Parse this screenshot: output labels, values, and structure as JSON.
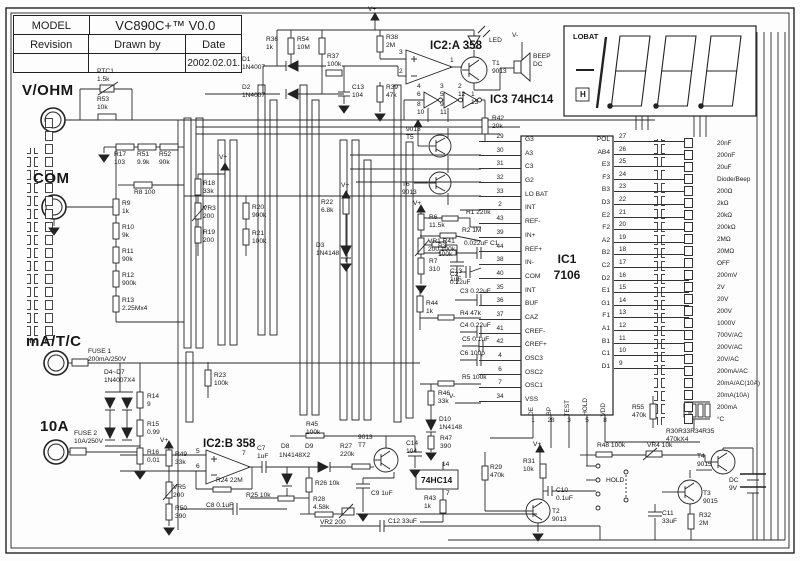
{
  "title_block": {
    "model_label": "MODEL",
    "model_value": "VC890C+™ V0.0",
    "revision_label": "Revision",
    "drawn_by_label": "Drawn by",
    "date_label": "Date",
    "date_value": "2002.02.01."
  },
  "terminals": {
    "vohm": "V/OHM",
    "com": "COM",
    "matc": "mA/T/C",
    "a10": "10A"
  },
  "display": {
    "lobat": "LOBAT",
    "hold_symbol": "H"
  },
  "ic1": {
    "name": "IC1",
    "part": "7106",
    "left_pins": [
      {
        "n": "29",
        "l": "G3"
      },
      {
        "n": "30",
        "l": "A3"
      },
      {
        "n": "31",
        "l": "C3"
      },
      {
        "n": "32",
        "l": "G2"
      },
      {
        "n": "33",
        "l": "LO BAT"
      },
      {
        "n": "2",
        "l": "INT"
      },
      {
        "n": "43",
        "l": "REF-"
      },
      {
        "n": "39",
        "l": "IN+"
      },
      {
        "n": "44",
        "l": "REF+"
      },
      {
        "n": "38",
        "l": "IN-"
      },
      {
        "n": "40",
        "l": "COM"
      },
      {
        "n": "35",
        "l": "INT"
      },
      {
        "n": "36",
        "l": "BUF"
      },
      {
        "n": "37",
        "l": "CAZ"
      },
      {
        "n": "41",
        "l": "CREF-"
      },
      {
        "n": "42",
        "l": "CREF+"
      },
      {
        "n": "4",
        "l": "OSC3"
      },
      {
        "n": "6",
        "l": "OSC2"
      },
      {
        "n": "7",
        "l": "OSC1"
      },
      {
        "n": "34",
        "l": "VSS"
      }
    ],
    "right_pins": [
      {
        "l": "POL",
        "n": "27"
      },
      {
        "l": "AB4",
        "n": "26"
      },
      {
        "l": "E3",
        "n": "25"
      },
      {
        "l": "F3",
        "n": "24"
      },
      {
        "l": "B3",
        "n": "23"
      },
      {
        "l": "D3",
        "n": "22"
      },
      {
        "l": "E2",
        "n": "21"
      },
      {
        "l": "F2",
        "n": "20"
      },
      {
        "l": "A2",
        "n": "19"
      },
      {
        "l": "B2",
        "n": "18"
      },
      {
        "l": "C2",
        "n": "17"
      },
      {
        "l": "D2",
        "n": "16"
      },
      {
        "l": "E1",
        "n": "15"
      },
      {
        "l": "G1",
        "n": "14"
      },
      {
        "l": "F1",
        "n": "13"
      },
      {
        "l": "A1",
        "n": "12"
      },
      {
        "l": "B1",
        "n": "11"
      },
      {
        "l": "C1",
        "n": "10"
      },
      {
        "l": "D1",
        "n": "9"
      }
    ],
    "bottom_pins": [
      {
        "l": "DE",
        "n": "1"
      },
      {
        "l": "BP",
        "n": "28"
      },
      {
        "l": "TEST",
        "n": "3"
      },
      {
        "l": "HOLD",
        "n": "5"
      },
      {
        "l": "VDD",
        "n": "8"
      }
    ]
  },
  "ranges": [
    "20nF",
    "200nF",
    "20uF",
    "Diode/Beep",
    "200Ω",
    "2kΩ",
    "20kΩ",
    "200kΩ",
    "2MΩ",
    "20MΩ",
    "OFF",
    "200mV",
    "2V",
    "20V",
    "200V",
    "1000V",
    "700V/AC",
    "200V/AC",
    "20V/AC",
    "200mA/AC",
    "20mA/AC(10A)",
    "20mA(10A)",
    "200mA",
    "°C"
  ],
  "parts": {
    "ptc1": "PTC1\n1.5k",
    "r53": "R53\n10k",
    "r17": "R17\n103",
    "r51": "R51\n9.9k",
    "r52": "R52\n90k",
    "r8": "R8  100",
    "r9": "R9\n1k",
    "r10": "R10\n9k",
    "r11": "R11\n90k",
    "r12": "R12\n900k",
    "r13": "R13\n2.25Mx4",
    "fuse1": "FUSE 1\n200mA/250V",
    "d4d7": "D4~D7\n1N4007X4",
    "r14": "R14\n9",
    "r15": "R15\n0.99",
    "r16": "R16\n0.01",
    "fuse2": "FUSE 2\n10A/250V",
    "vplus1": "V+",
    "r49": "R49\n33k",
    "vr5": "VR5\n200",
    "r50": "R50\n390",
    "r36": "R36\n1k",
    "r54": "R54\n10M",
    "d1": "D1\n1N4007",
    "d2": "D2\n1N4007",
    "r37": "R37\n100k",
    "c13a": "C13\n104",
    "r38": "R38\n2M",
    "r39": "R39\n47k",
    "vplus2": "V+",
    "ic2a": "IC2:A 358",
    "p3": "3",
    "p2": "2",
    "p1": "1",
    "led": "LED",
    "vminus1": "V-",
    "t1": "T1\n9013",
    "beep": "BEEP\nDC",
    "ic3": "IC3  74HC14",
    "g1a": "4\n6",
    "g1b": "8\n10",
    "g2a": "3\n5",
    "g2b": "9\n11",
    "g3a": "2\n12",
    "g3b": "1\n13",
    "r42": "R42\n20k",
    "r18": "R18\n33k",
    "vr3": "VR3\n200",
    "r19": "R19\n200",
    "vplus3": "V+",
    "r20": "R20\n900k",
    "r21": "R21\n100k",
    "r23": "R23\n100k",
    "vplus4": "V+",
    "r22": "R22\n6.8k",
    "d3": "D3\n1N4148",
    "t5": "9013\nT5",
    "t6": "T6\n9013",
    "vplus5": "V+",
    "r6": "R6\n11.5k",
    "vr1r41": "VR1 R41\n200 100k",
    "r7": "R7\n310",
    "c13b": "C13\n1uF",
    "r1": "R1  220k",
    "r2": "R2  1M",
    "r3": "R3\n100k",
    "c1": "0.022uF C1",
    "c2": "C2\n0.22uF",
    "c3": "C3   0.22uF",
    "r4": "R4   47k",
    "c4": "C4   0.22uF",
    "c5": "C5    0.1uF",
    "c6": "C6   100p",
    "r5": "R5   100k",
    "r44": "R44\n1k",
    "r46": "R46\n33k",
    "vminus2": "V-",
    "ic2b": "IC2:B 358",
    "p5": "5",
    "p6": "6",
    "p7": "7",
    "r24": "R24 22M",
    "c7": "C7\n1uF",
    "d8": "D8",
    "d9": "D9",
    "d89": "1N4148X2",
    "r27": "R27\n220k",
    "r45": "R45\n100k",
    "t7": "9013\nT7",
    "c14": "C14\n104",
    "r25": "R25 10k",
    "r26": "R26 10k",
    "r28": "R28\n4.58k",
    "vr2": "VR2 200",
    "c9": "C9  1uF",
    "c8": "C8     0.1uF",
    "c12": "C12  33uF",
    "hc14": "74HC14",
    "p14": "14",
    "p7b": "7",
    "r43": "R43\n1k",
    "d10": "D10\n1N4148",
    "r47": "R47\n390",
    "r29": "R29\n470k",
    "r31": "R31\n10k",
    "vplus6": "V+",
    "c10": "C10\n0.1uF",
    "t2": "T2\n9013",
    "hold": "HOLD",
    "r48": "R48  100k",
    "vr4": "VR4  10k",
    "r55": "R55\n470k",
    "r30": "R30R33R34R35\n470kX4",
    "t4": "T4\n9015",
    "t3": "T3\n9015",
    "dc": "DC\n9V",
    "c11": "C11\n33uF",
    "r32": "R32\n2M"
  }
}
